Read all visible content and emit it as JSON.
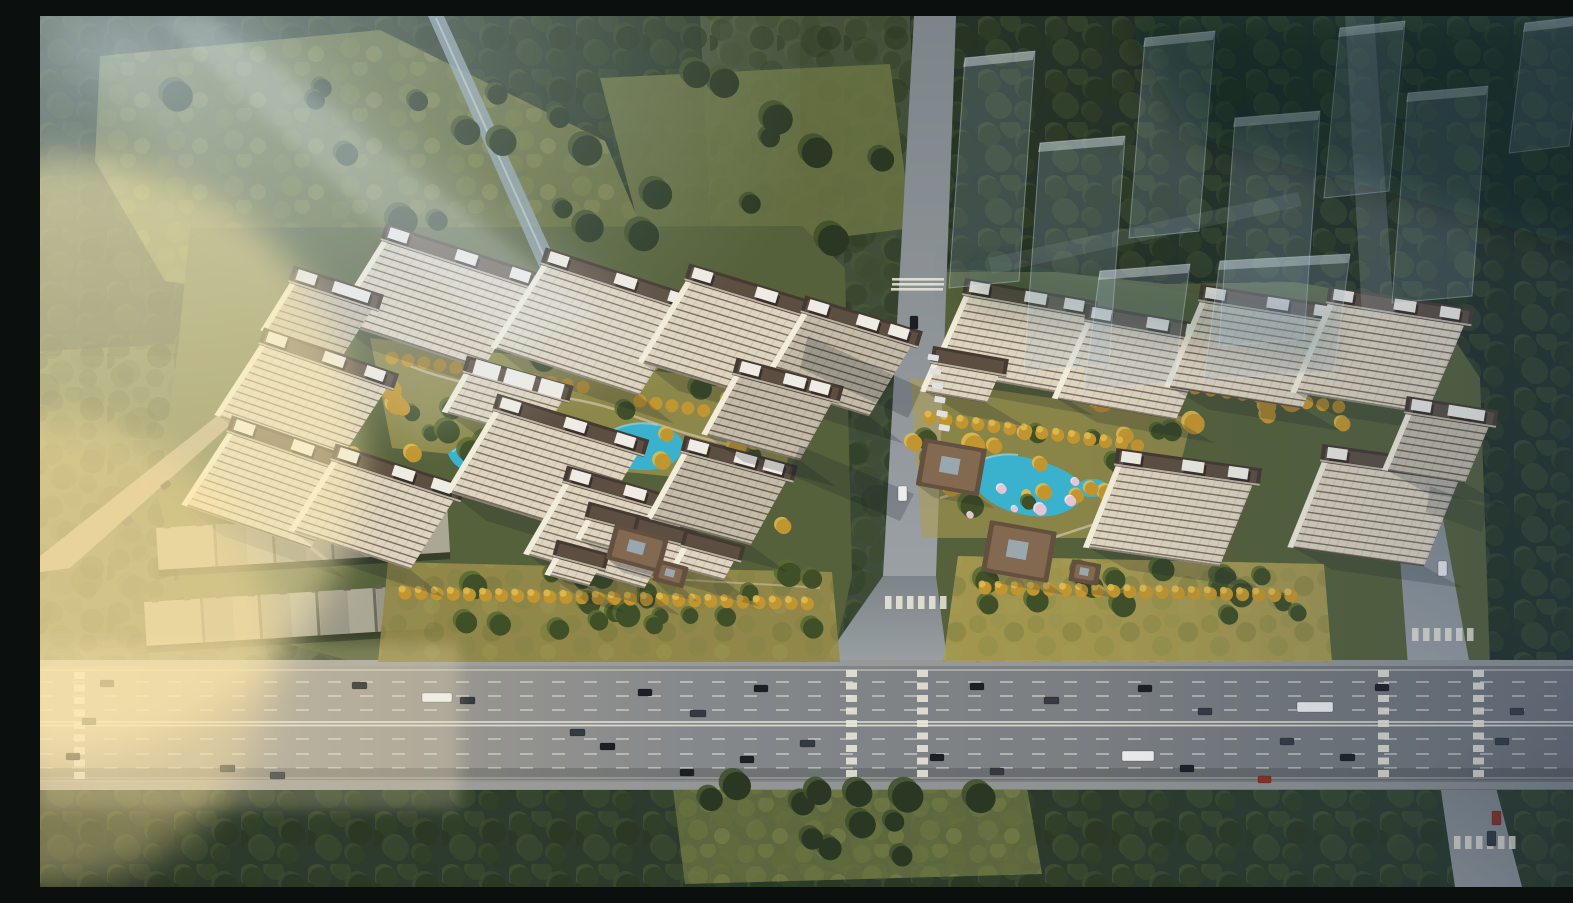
{
  "meta": {
    "title": "Aerial rendering of a twin-cluster residential development at golden hour",
    "type": "architectural-visualization",
    "width_px": 1573,
    "height_px": 871
  },
  "scene": {
    "description": "Bird's-eye view of two residential compounds separated by a tree-lined central avenue, fronted by a wide multi-lane boulevard with traffic; surrounded by dense forest, with semi-transparent future-phase towers ghosted over the woods at the upper right and warm sunlight flooding in from the left.",
    "lighting": "low warm sun from west (left), long shadows cast eastward, hazy blue tint to the northeast",
    "clusters": {
      "west": {
        "name": "west-residential-cluster",
        "tower_count": 13,
        "villa_count": 4,
        "features": [
          "landscape axis with three ponds",
          "golden ornamental trees",
          "pink blossom trees",
          "south entrance gate pavilion",
          "courtyard low-rise with white roof decks"
        ]
      },
      "east": {
        "name": "east-residential-cluster",
        "tower_count": 8,
        "features": [
          "central lake-style swimming pool",
          "two chinese-style clubhouse pavilions",
          "golden ornamental trees",
          "pink blossom trees",
          "south lawn with tree groves"
        ]
      }
    },
    "roads": [
      {
        "name": "front-boulevard",
        "lanes": 8,
        "direction": "east-west",
        "crosswalks": 5
      },
      {
        "name": "central-avenue",
        "direction": "north-south",
        "tree_lined": true
      },
      {
        "name": "east-street",
        "direction": "north-south",
        "crosswalks": 3
      },
      {
        "name": "service-road",
        "direction": "diagonal-southwest"
      },
      {
        "name": "forest-canal",
        "direction": "diagonal-northwest"
      }
    ],
    "structures": {
      "warehouse_rows": 2,
      "clubhouse_pavilions": 5,
      "ghost_future_towers": 9,
      "pools_and_ponds": 5
    },
    "vehicles": {
      "cars": 34,
      "buses": 3,
      "bus_color": "white"
    },
    "vegetation": [
      "dense dark forest",
      "meadow clearings",
      "street tree rows",
      "golden autumn trees",
      "pink blossom trees",
      "south lawns"
    ],
    "palette": {
      "bgLeft": "#5e6a41",
      "forestDark": "#2b3a2c",
      "forestDarker": "#233027",
      "canopy1": "#324226",
      "canopy2": "#3c4c2d",
      "canopy3": "#29371f",
      "canopyLit": "#526332",
      "meadow": "#6a7343",
      "lawn": "#95894a",
      "lawnLit": "#ab9c52",
      "clusterGround": "#55613a",
      "gold": "#c1952f",
      "goldLight": "#e0ba4e",
      "blossomPink": "#e7c3d4",
      "blossomLight": "#f6ebf1",
      "pool": "#3ab2cd",
      "poolDeep": "#2388a8",
      "poolLight": "#8fd8e6",
      "roadHwyL": "#b6b1a2",
      "roadHwyM": "#84888b",
      "roadHwyR": "#6d7175",
      "roadV": "#8d9398",
      "canal": "#8fa3ad",
      "laneLine": "#dedcd2",
      "laneSolid": "#eceadc",
      "pathTan": "#cbbd9d",
      "carDark1": "#1c2025",
      "carDark2": "#343a42",
      "carWhite": "#ecedee",
      "carRed": "#8a3024",
      "facade": "#ded4bf",
      "facadeLine": "#6e6455",
      "facadeShade": "#c4bba8",
      "facadeShadeLine": "#5c5346",
      "gable": "#f2ecda",
      "roofDark": "#453a31",
      "roofMid": "#5c4e41",
      "roofWhite": "#eeece4",
      "pavRoof": "#63503f",
      "pavRoofRidge": "#82694f",
      "whRoof": "#aaa795",
      "whRoofDark": "#8d8a7c",
      "whSeam": "#5f5c50",
      "shadow": "rgba(16,26,42,0.40)",
      "ghostFill": "rgba(165,185,205,0.22)",
      "ghostEdge": "rgba(220,232,242,0.38)",
      "ghostRoad": "rgba(200,215,228,0.22)",
      "sunGlow": "rgba(255,238,178,0.55)",
      "sunGlow2": "rgba(255,224,150,0.42)",
      "hazeTL": "rgba(208,224,234,0.55)",
      "blueTint": "rgba(40,65,100,0.28)",
      "beam": "rgba(225,238,245,0.16)"
    }
  }
}
